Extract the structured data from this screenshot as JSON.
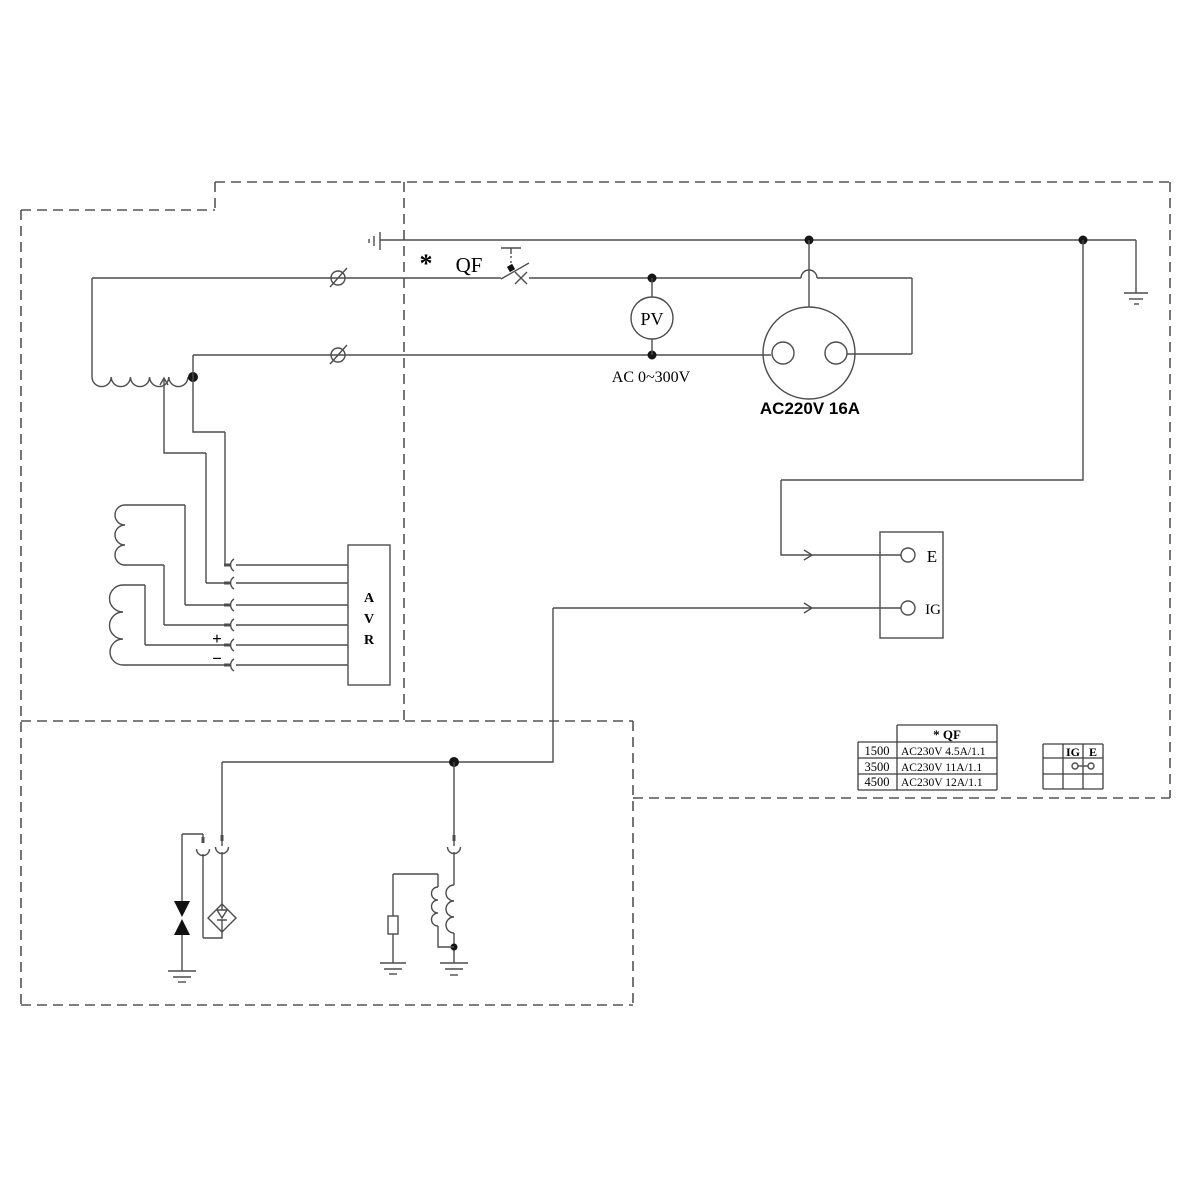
{
  "colors": {
    "line": "#4d4d4d",
    "text": "#000000",
    "background": "#ffffff"
  },
  "labels": {
    "asterisk": "*",
    "qf": "QF",
    "pv": "PV",
    "ac_range": "AC 0~300V",
    "socket": "AC220V 16A",
    "terminal_e": "E",
    "terminal_ig": "IG",
    "avr_a": "A",
    "avr_v": "V",
    "avr_r": "R",
    "plus": "+",
    "minus": "−"
  },
  "qf_table": {
    "header": "*  QF",
    "rows": [
      {
        "model": "1500",
        "spec": "AC230V 4.5A/1.1"
      },
      {
        "model": "3500",
        "spec": "AC230V 11A/1.1"
      },
      {
        "model": "4500",
        "spec": "AC230V 12A/1.1"
      }
    ]
  },
  "switch_table": {
    "col_ig": "IG",
    "col_e": "E"
  }
}
